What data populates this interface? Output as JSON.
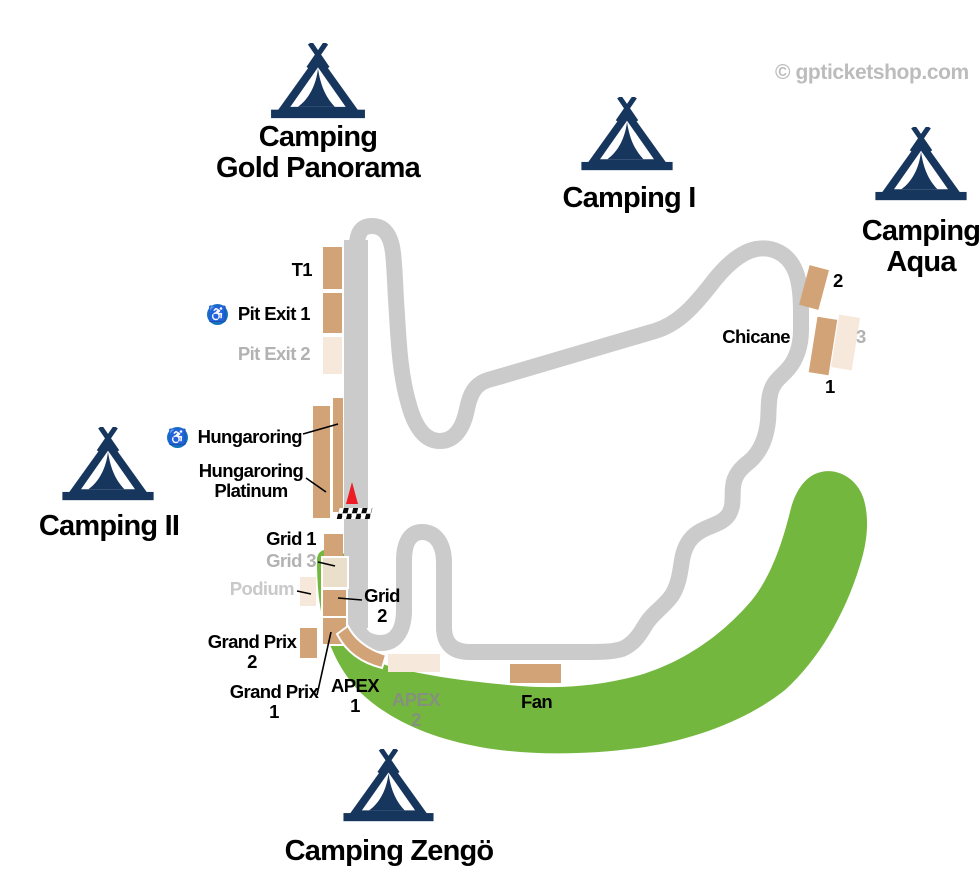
{
  "watermark": "© gpticketshop.com",
  "colors": {
    "navy": "#17365d",
    "tan": "#d1a376",
    "pale": "#f6e8da",
    "cream": "#e9dfca",
    "green": "#74b73f",
    "track": "#cbcbcb",
    "muted": "#b2b2b2",
    "podium_text": "#c9c9c9",
    "apex2_text": "#85917c",
    "red": "#ed1c24",
    "blue": "#1273bd",
    "watermark": "#bcbcbc"
  },
  "icons": {
    "wheelchair_glyph": "♿"
  },
  "campsites": {
    "gold_panorama": {
      "l1": "Camping",
      "l2": "Gold Panorama"
    },
    "camping_i": {
      "l1": "Camping I"
    },
    "aqua": {
      "l1": "Camping",
      "l2": "Aqua"
    },
    "camping_ii": {
      "l1": "Camping II"
    },
    "zengo": {
      "l1": "Camping Zengö"
    }
  },
  "grandstand_labels": {
    "t1": "T1",
    "pit_exit_1": "Pit Exit 1",
    "pit_exit_2": "Pit Exit 2",
    "hungaroring": "Hungaroring",
    "hungaroring_platinum_l1": "Hungaroring",
    "hungaroring_platinum_l2": "Platinum",
    "grid_1": "Grid 1",
    "grid_3": "Grid 3",
    "podium": "Podium",
    "grid_2_l1": "Grid",
    "grid_2_l2": "2",
    "grand_prix_2_l1": "Grand Prix",
    "grand_prix_2_l2": "2",
    "grand_prix_1_l1": "Grand Prix",
    "grand_prix_1_l2": "1",
    "apex_1_l1": "APEX",
    "apex_1_l2": "1",
    "apex_2_l1": "APEX",
    "apex_2_l2": "2",
    "fan": "Fan",
    "chicane": "Chicane",
    "stand_2": "2",
    "stand_3": "3",
    "stand_1": "1"
  }
}
